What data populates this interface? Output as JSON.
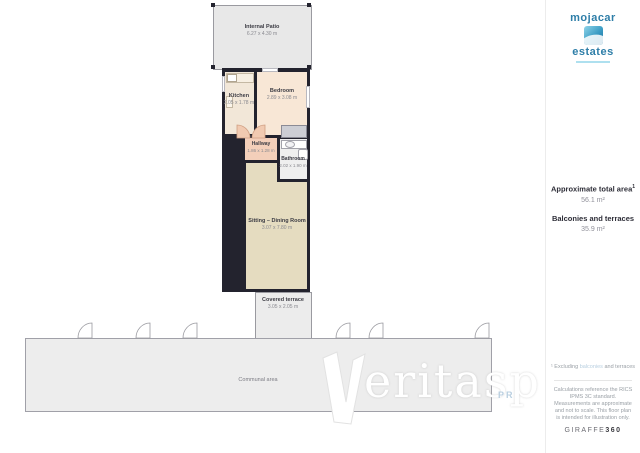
{
  "plan": {
    "rooms": {
      "patio": {
        "name": "Internal Patio",
        "dims": "6.27 x 4.30 m"
      },
      "kitchen": {
        "name": "Kitchen",
        "dims": "2.05 x 1.78 m"
      },
      "bedroom": {
        "name": "Bedroom",
        "dims": "2.89 x 3.08 m"
      },
      "hallway": {
        "name": "Hallway",
        "dims": "1.86 x 1.28 m"
      },
      "bathroom": {
        "name": "Bathroom",
        "dims": "2.02 x 1.90 m"
      },
      "sitting": {
        "name": "Sitting – Dining Room",
        "dims": "3.07 x 7.80 m"
      },
      "terrace": {
        "name": "Covered terrace",
        "dims": "3.05 x 2.05 m"
      },
      "communal": {
        "name": "Communal area"
      }
    },
    "watermark": {
      "text": "eritasp",
      "sub": "PR"
    }
  },
  "sidebar": {
    "logo": {
      "top": "mojacar",
      "bottom": "estates"
    },
    "areas": {
      "total_label": "Approximate total area",
      "total_sup": "1",
      "total_value": "56.1 m²",
      "balconies_label": "Balconies and terraces",
      "balconies_value": "35.9 m²"
    },
    "footnote": {
      "prefix": "¹ Excluding ",
      "highlight": "balconies",
      "suffix": " and terraces"
    },
    "disclaimer": "Calculations reference the RICS IPMS 3C standard. Measurements are approximate and not to scale. This floor plan is intended for illustration only.",
    "brand": {
      "name": "GIRAFFE",
      "suffix": "360"
    }
  },
  "colors": {
    "wall": "#23232e",
    "logo_blue": "#2e7ea8",
    "footnote_highlight": "#b8cfe0",
    "patio_fill": "#e8e8e8",
    "kitchen_fill": "#f2e7d8",
    "bedroom_fill": "#f8e7d6",
    "hallway_fill": "#f3cfba",
    "sitting_fill": "#e5dcc0",
    "communal_fill": "#ededed"
  }
}
